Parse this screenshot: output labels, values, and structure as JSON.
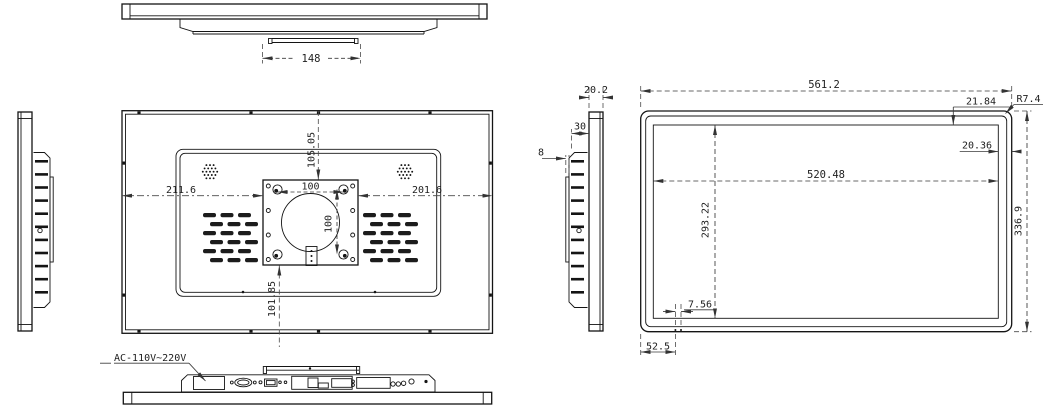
{
  "drawing": {
    "top_view": {
      "stand_width": "148"
    },
    "back_view": {
      "top_offset": "105.05",
      "left_offset": "211.6",
      "right_offset": "201.6",
      "vesa_width": "100",
      "vesa_height": "100",
      "bottom_offset": "101.85"
    },
    "side_view": {
      "panel_thickness": "20.2",
      "body_depth": "30",
      "bracket_thickness": "8"
    },
    "front_view": {
      "overall_width": "561.2",
      "top_bezel": "21.84",
      "corner_radius": "R7.4",
      "right_bezel": "20.36",
      "display_width": "520.48",
      "display_height": "293.22",
      "overall_height": "336.9",
      "hole_pitch": "7.56",
      "bottom_left_offset": "52.5"
    },
    "bottom_view": {
      "power_label": "AC-110V~220V"
    },
    "colors": {
      "object_line": "#141414",
      "dimension_line": "#3a3a3a",
      "background": "#ffffff"
    }
  }
}
